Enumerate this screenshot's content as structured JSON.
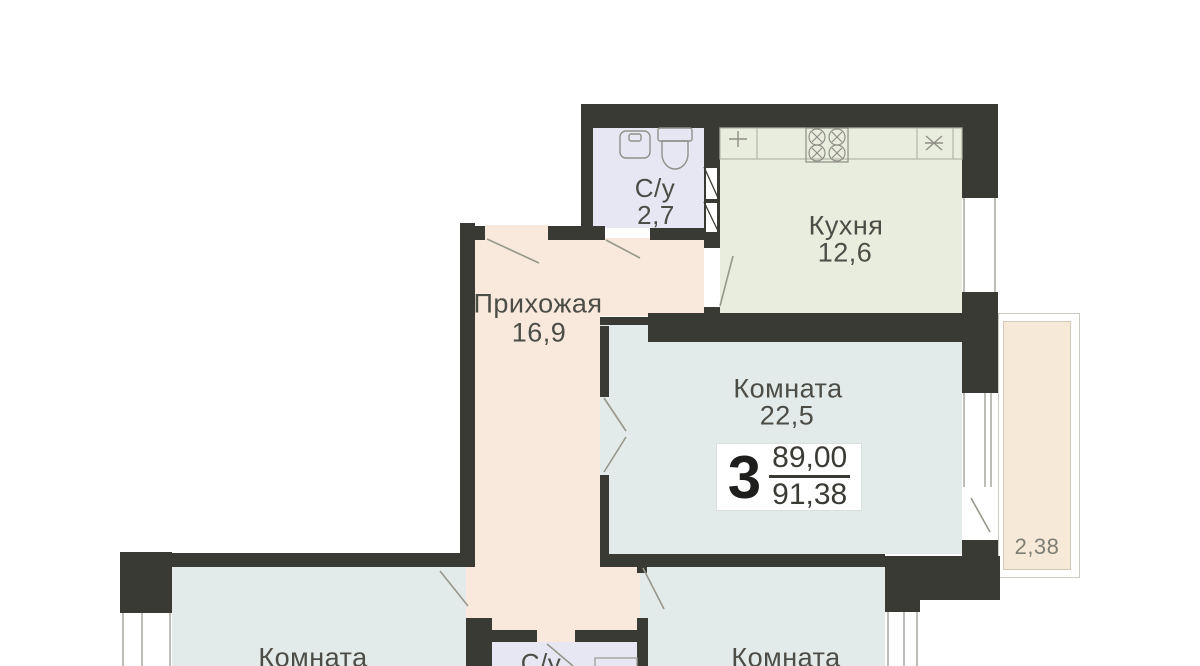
{
  "rooms": {
    "bathroom_top": {
      "name": "С/у",
      "area": "2,7"
    },
    "kitchen": {
      "name": "Кухня",
      "area": "12,6"
    },
    "hallway": {
      "name": "Прихожая",
      "area": "16,9"
    },
    "living_room": {
      "name": "Комната",
      "area": "22,5"
    },
    "room_bottom_left": {
      "name": "Комната"
    },
    "room_bottom_right": {
      "name": "Комната"
    },
    "bathroom_bottom": {
      "name": "С/у"
    },
    "balcony": {
      "area": "2,38"
    }
  },
  "stamp": {
    "rooms_count": "3",
    "area_top": "89,00",
    "area_bottom": "91,38"
  },
  "icons": {
    "toilet": "tank-and-bowl outline",
    "bath_sink": "rounded square",
    "kitchen_faucet": "cross",
    "stove": "four crossed burners",
    "fridge": "asterisk",
    "vent_shaft": "box with diagonal",
    "washing_machine": "square outline",
    "door_swing": "diagonal leaf line",
    "window": "double-line strip"
  },
  "colors": {
    "wall": "#3a3a34",
    "hallway_floor": "#f8e9dc",
    "kitchen_floor": "#e9eddd",
    "room_floor": "#e2ebe9",
    "bathroom_floor": "#e7e7f3",
    "balcony_floor": "#f7e9d8",
    "label_text": "#4d4d47"
  }
}
